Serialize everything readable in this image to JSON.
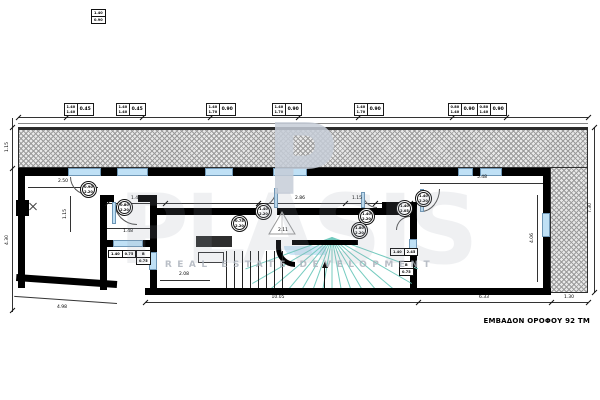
{
  "title_block": {
    "area_label": "ΕΜΒΑΔΟΝ ΟΡΟΦΟΥ 92 ΤΜ"
  },
  "watermark": {
    "initial": "P",
    "word": "PLASIS",
    "tagline": "REAL ESTATE DEVELOPMENT"
  },
  "colors": {
    "wall": "#000000",
    "window_fill": "#bfe0f5",
    "window_stroke": "#6e96b5",
    "stair_tread_green": "#74cbbf",
    "hatch_gray": "#e8e8e8",
    "watermark_gray": "#c6cdd8"
  },
  "window_tags": [
    {
      "w": "1.40",
      "h": "1.40",
      "sill": "0.45"
    },
    {
      "w": "1.40",
      "h": "1.40",
      "sill": "0.45"
    },
    {
      "w": "1.40",
      "h": "1.70",
      "sill": "0.90"
    },
    {
      "w": "1.40",
      "h": "1.70",
      "sill": "0.90"
    },
    {
      "w": "1.40",
      "h": "1.70",
      "sill": "0.90"
    },
    {
      "w": "0.80",
      "h": "1.40",
      "sill": "0.90"
    },
    {
      "w": "0.80",
      "h": "1.40",
      "sill": "0.90"
    }
  ],
  "door_tags": [
    {
      "top": "0.90",
      "bottom": "2.20"
    },
    {
      "top": "0.80",
      "bottom": "2.20"
    },
    {
      "top": "1.40",
      "bottom": "2.20"
    },
    {
      "top": "0.75",
      "bottom": "2.20"
    },
    {
      "top": "1.40",
      "bottom": "2.20"
    },
    {
      "top": "1.80",
      "bottom": "2.20"
    },
    {
      "top": "1.40",
      "bottom": "2.05"
    },
    {
      "top": "1.40",
      "bottom": "2.20"
    }
  ],
  "mini_tags": [
    {
      "a": "1.40",
      "b": "0.75"
    },
    {
      "a": "B",
      "b": "0.75"
    },
    {
      "a": "1.40",
      "b": "2.45"
    },
    {
      "a": "B",
      "b": "0.75"
    },
    {
      "a": "1.40",
      "b": "0.90"
    }
  ],
  "dimensions": {
    "band_height": "1.15",
    "left_height": "4.30",
    "left_room_width": "2.50",
    "left_room_inner": "1.15",
    "left_wing_bottom": "4.98",
    "wc_width": "1.48",
    "hall_a": "1.47",
    "hall_b": "2.86",
    "hall_c": "1.15",
    "stair_width": "2.11",
    "mid_room_width": "2.08",
    "center_bottom": "10.05",
    "right_room_width": "5.48",
    "right_room_height": "4.06",
    "right_bottom": "6.33",
    "balcony_width": "1.30",
    "right_total": "7.30"
  }
}
